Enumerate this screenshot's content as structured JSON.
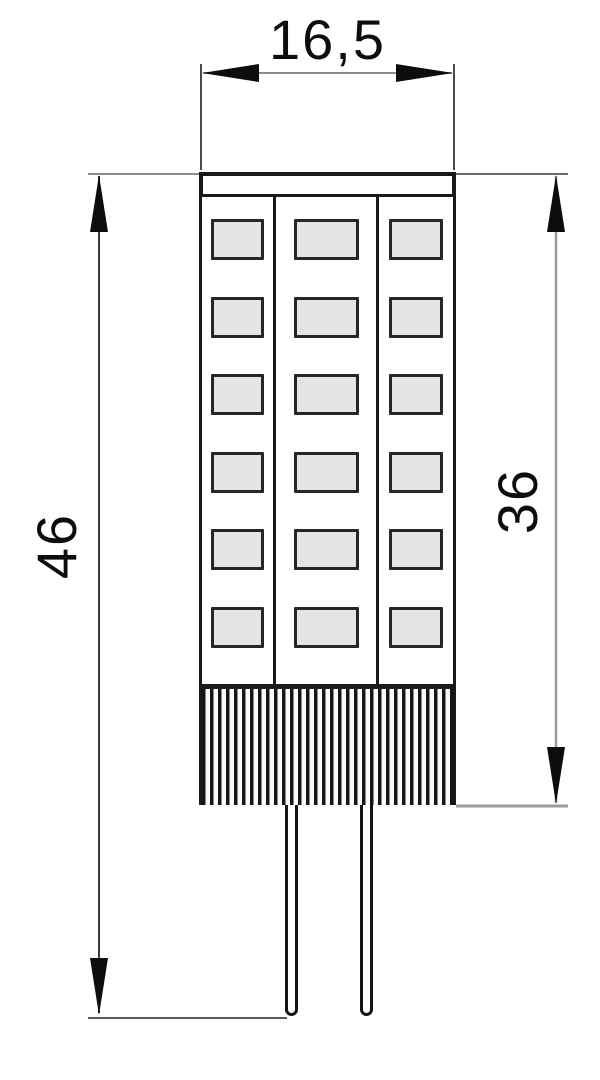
{
  "drawing": {
    "labels": {
      "width": "16,5",
      "total_height": "46",
      "body_height": "36"
    },
    "led_grid": {
      "columns": 3,
      "rows": 6
    },
    "pin_count": 2
  },
  "colors": {
    "ink": "#1a1a1a",
    "dim_line": "#8c8c8c",
    "chip_fill": "#e4e4e4",
    "background": "#ffffff"
  }
}
